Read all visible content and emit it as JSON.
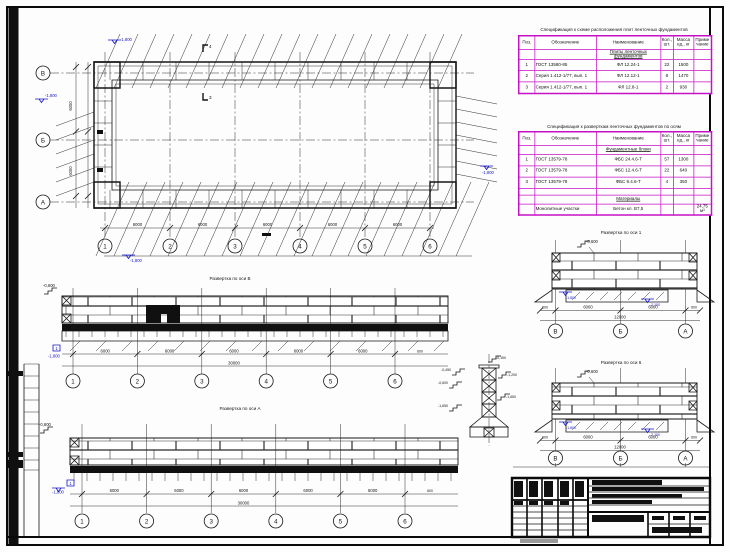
{
  "axes": {
    "numbers": [
      "1",
      "2",
      "3",
      "4",
      "5",
      "6"
    ],
    "letters": [
      "В",
      "Б",
      "А"
    ]
  },
  "dims": {
    "bay": "6000",
    "edge": "600",
    "total_long": "30000",
    "total_short": "12000"
  },
  "levels": {
    "zero": "-0,600",
    "low": "-1,800",
    "lower": "-2,100",
    "sec": [
      "-0,150",
      "-0,450",
      "-1,200",
      "-1,650"
    ]
  },
  "flags": {
    "plan_top": "4",
    "plan_mid": "3",
    "pos": "1"
  },
  "titles": {
    "elev_mid": "Развертка по оси В",
    "elev_bottom": "Развертка по оси А",
    "detail_1": "Развертка по оси 1",
    "detail_6": "Развертка по оси 6"
  },
  "spec_columns": [
    "Поз.",
    "Обозначение",
    "Наименование",
    "Кол., шт.",
    "Масса ед., кг",
    "Примечание"
  ],
  "spec_table_1": {
    "title": "Спецификация к схеме расположения плит ленточных фундаментов",
    "group": "Плиты ленточных фундаментов",
    "rows": [
      [
        "1",
        "ГОСТ 13580-85",
        "ФЛ 12.24-1",
        "22",
        "1500",
        ""
      ],
      [
        "2",
        "Серия 1.412-1/77, вып. 1",
        "ФЛ 12.12-1",
        "8",
        "1470",
        ""
      ],
      [
        "3",
        "Серия 1.412-1/77, вып. 1",
        "ФЛ 12.8-1",
        "2",
        "930",
        ""
      ]
    ]
  },
  "spec_table_2": {
    "title": "Спецификация к разверткам ленточных фундаментов по осям",
    "group": "Фундаментные блоки",
    "rows": [
      [
        "1",
        "ГОСТ 13579-78",
        "ФБС 24.4.6-Т",
        "57",
        "1300",
        ""
      ],
      [
        "2",
        "ГОСТ 13579-78",
        "ФБС 12.4.6-Т",
        "22",
        "640",
        ""
      ],
      [
        "3",
        "ГОСТ 13579-78",
        "ФБС 9.4.6-Т",
        "4",
        "350",
        ""
      ]
    ],
    "group2": "Материалы",
    "material_row": [
      "",
      "Монолитные участки",
      "Бетон кл. В7,5",
      "",
      "",
      "24,75 м³"
    ]
  }
}
